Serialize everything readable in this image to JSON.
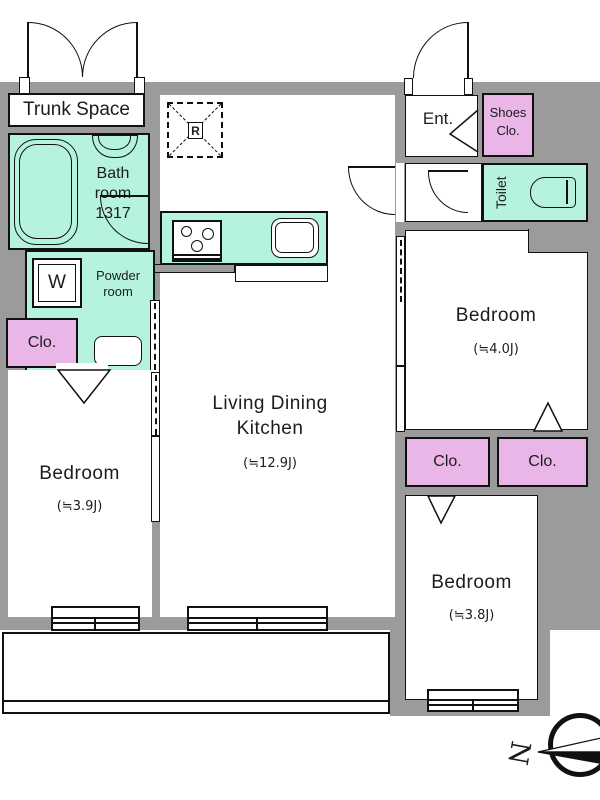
{
  "plan": {
    "type": "apartment-floor-plan",
    "colors": {
      "wall_gray": "#9b9b9b",
      "mint": "#b5f2df",
      "pink": "#eab6e8",
      "line": "#111111",
      "bg": "#ffffff"
    },
    "rooms": {
      "trunk_space": {
        "label": "Trunk Space"
      },
      "bathroom": {
        "line1": "Bath",
        "line2": "room",
        "line3": "1317"
      },
      "powder_room": {
        "line1": "Powder",
        "line2": "room",
        "washer": "W"
      },
      "ldk": {
        "name1": "Living Dining",
        "name2": "Kitchen",
        "size": "(≒12.9J)"
      },
      "bedroom_west": {
        "name": "Bedroom",
        "size": "(≒3.9J)"
      },
      "bedroom_east": {
        "name": "Bedroom",
        "size": "(≒4.0J)"
      },
      "bedroom_south": {
        "name": "Bedroom",
        "size": "(≒3.8J)"
      },
      "entrance": {
        "label": "Ent."
      },
      "shoes_closet": {
        "line1": "Shoes",
        "line2": "Clo."
      },
      "toilet": {
        "label": "Toilet"
      },
      "closet_west": {
        "label": "Clo."
      },
      "closet_east_1": {
        "label": "Clo."
      },
      "closet_east_2": {
        "label": "Clo."
      },
      "refrigerator": {
        "label": "R"
      }
    },
    "compass": {
      "north_label": "N"
    }
  }
}
